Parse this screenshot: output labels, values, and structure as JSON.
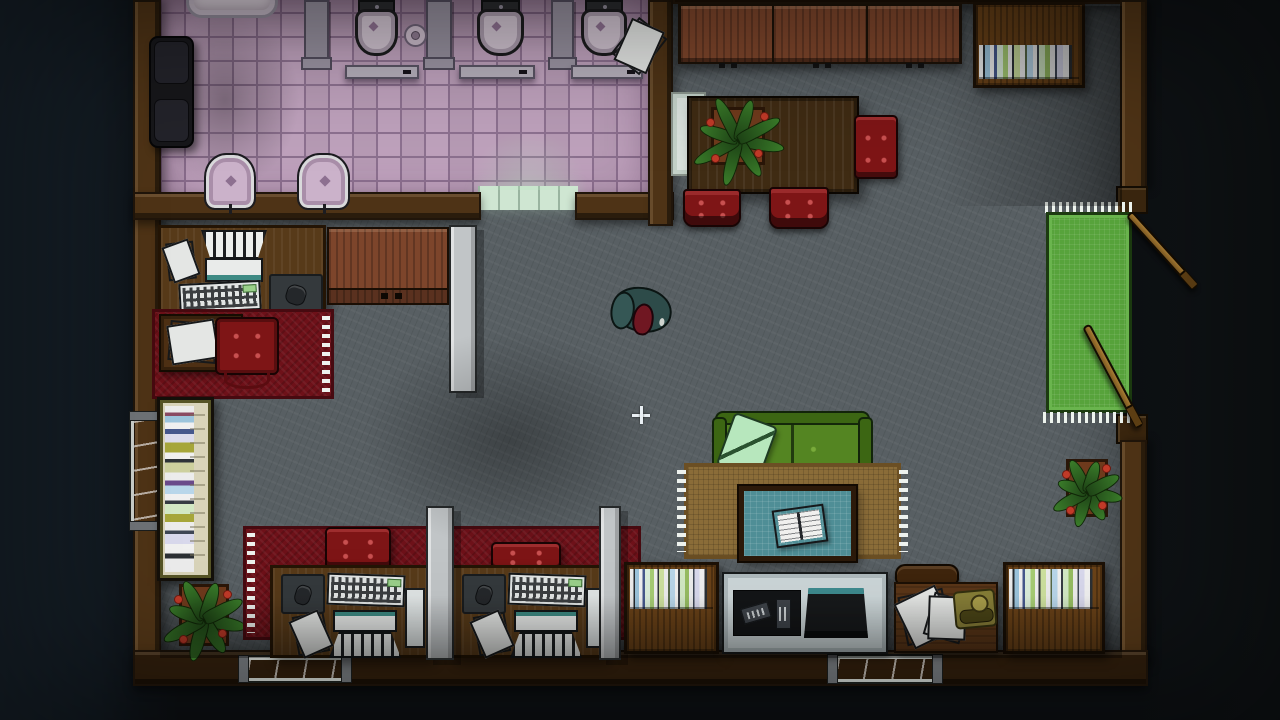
{
  "palette": {
    "floor": "#585f63",
    "tile": "#bfa2bd",
    "tile-grout": "#8d7190",
    "threshold": "#cfe6d2",
    "wall": "#4e3316",
    "wall-dark": "#20150a",
    "wood-panel": "#7d452b",
    "shelf-wood": "#6a4218",
    "table-wood": "#3f2b13",
    "desk-wood": "#573a19",
    "red-furn": "#7e1516",
    "red-rug": "#6e1119",
    "sofa": "#548522",
    "sofa-frame": "#3c6613",
    "pillow": "#b7e7bd",
    "rug-tan": "#8a6c38",
    "rug-tan-dark": "#6b4f24",
    "teal-table": "#4f8e96",
    "partition": "#c1c5c7",
    "window": "#74d6e4",
    "window-hi": "#b2eef6",
    "mat": "#57a33b",
    "flower": "#c03a28",
    "paper": "#eceeec",
    "phone": "#867d37",
    "tvstand": "#ccd6d8",
    "jacket": "#2d4b49",
    "head": "#701722",
    "crosshair": "#e9eff3"
  },
  "scene": {
    "width": 1280,
    "height": 720,
    "entities": [
      {
        "name": "main-floor",
        "type": "floor-main",
        "x": 160,
        "y": 4,
        "w": 962,
        "h": 656
      },
      {
        "name": "bathroom-floor",
        "type": "floor-bath",
        "x": 160,
        "y": 0,
        "w": 490,
        "h": 206
      },
      {
        "name": "bathroom-corner-shade",
        "type": "shade-d",
        "x": 150,
        "y": 10,
        "w": 150,
        "h": 180
      },
      {
        "name": "bathroom-door-threshold",
        "type": "threshold",
        "x": 478,
        "y": 186,
        "w": 100,
        "h": 24
      },
      {
        "name": "bathroom-door-glow",
        "type": "glow-door",
        "x": 468,
        "y": 130,
        "w": 120,
        "h": 60
      },
      {
        "name": "wall-left",
        "type": "wall",
        "variant": "v",
        "x": 133,
        "y": 0,
        "w": 28,
        "h": 670
      },
      {
        "name": "wall-bathroom-south-left",
        "type": "wall",
        "variant": "h",
        "x": 133,
        "y": 192,
        "w": 348,
        "h": 28
      },
      {
        "name": "wall-bathroom-south-right",
        "type": "wall",
        "variant": "h",
        "x": 575,
        "y": 192,
        "w": 99,
        "h": 28
      },
      {
        "name": "wall-bathroom-east",
        "type": "wall",
        "variant": "v",
        "x": 648,
        "y": 0,
        "w": 25,
        "h": 226
      },
      {
        "name": "wall-top-right",
        "type": "wall",
        "variant": "h dark",
        "x": 673,
        "y": -8,
        "w": 450,
        "h": 12
      },
      {
        "name": "wall-right-upper",
        "type": "wall",
        "variant": "v",
        "x": 1120,
        "y": 0,
        "w": 27,
        "h": 190
      },
      {
        "name": "door-jamb-upper",
        "type": "jamb",
        "x": 1116,
        "y": 186,
        "w": 32,
        "h": 28
      },
      {
        "name": "door-jamb-lower",
        "type": "jamb",
        "x": 1116,
        "y": 414,
        "w": 32,
        "h": 30
      },
      {
        "name": "wall-right-lower",
        "type": "wall",
        "variant": "v",
        "x": 1120,
        "y": 440,
        "w": 27,
        "h": 228
      },
      {
        "name": "wall-bottom",
        "type": "wall",
        "variant": "h dark",
        "x": 133,
        "y": 650,
        "w": 1015,
        "h": 36
      },
      {
        "name": "window-bottom-left",
        "type": "window",
        "x": 246,
        "y": 657,
        "w": 98,
        "h": 24
      },
      {
        "name": "window-bottom-right",
        "type": "window",
        "x": 835,
        "y": 656,
        "w": 100,
        "h": 26
      },
      {
        "name": "window-left-wall",
        "type": "window",
        "variant": "vert",
        "x": 131,
        "y": 418,
        "w": 29,
        "h": 106
      },
      {
        "name": "bathtub",
        "type": "bathtub",
        "x": 186,
        "y": -14,
        "w": 92,
        "h": 32
      },
      {
        "name": "black-armchair",
        "type": "armchair",
        "x": 149,
        "y": 36,
        "w": 45,
        "h": 112
      },
      {
        "name": "stall-divider-1",
        "type": "stall",
        "x": 304,
        "y": 0,
        "w": 25,
        "h": 64
      },
      {
        "name": "stall-divider-2",
        "type": "stall",
        "x": 426,
        "y": 0,
        "w": 26,
        "h": 64
      },
      {
        "name": "stall-divider-3",
        "type": "stall",
        "x": 551,
        "y": 0,
        "w": 23,
        "h": 64
      },
      {
        "name": "stall-door-1",
        "type": "stalldoor",
        "x": 345,
        "y": 65,
        "w": 74,
        "h": 14
      },
      {
        "name": "stall-door-2",
        "type": "stalldoor",
        "x": 459,
        "y": 65,
        "w": 76,
        "h": 14
      },
      {
        "name": "stall-door-3",
        "type": "stalldoor",
        "x": 571,
        "y": 65,
        "w": 72,
        "h": 14
      },
      {
        "name": "toilet-1",
        "type": "toilet",
        "x": 355,
        "y": 0,
        "w": 43,
        "h": 56
      },
      {
        "name": "toilet-2",
        "type": "toilet",
        "x": 477,
        "y": 0,
        "w": 47,
        "h": 56
      },
      {
        "name": "toilet-3",
        "type": "toilet",
        "x": 581,
        "y": 0,
        "w": 46,
        "h": 56
      },
      {
        "name": "toilet-paper-roll",
        "type": "roll",
        "x": 404,
        "y": 24,
        "w": 23,
        "h": 23
      },
      {
        "name": "scattered-papers-bathroom",
        "type": "papers",
        "x": 625,
        "y": 12,
        "w": 36,
        "h": 46,
        "rot": 38
      },
      {
        "name": "bidet-1",
        "type": "bidet",
        "x": 206,
        "y": 155,
        "w": 48,
        "h": 53
      },
      {
        "name": "bidet-2",
        "type": "bidet",
        "x": 299,
        "y": 155,
        "w": 49,
        "h": 53
      },
      {
        "name": "wall-cabinets",
        "type": "cabinets",
        "x": 678,
        "y": 4,
        "w": 284,
        "h": 60
      },
      {
        "name": "bookshelf-top-right",
        "type": "bookshelf",
        "variant": "books-mid",
        "x": 973,
        "y": 2,
        "w": 112,
        "h": 86
      },
      {
        "name": "glass-serving-tray",
        "type": "glass",
        "x": 671,
        "y": 92,
        "w": 35,
        "h": 84
      },
      {
        "name": "dining-table",
        "type": "table-wood",
        "x": 687,
        "y": 96,
        "w": 172,
        "h": 98
      },
      {
        "name": "dining-table-plant",
        "type": "plant",
        "x": 693,
        "y": 94,
        "w": 90,
        "h": 84
      },
      {
        "name": "dining-chair-east",
        "type": "redchair",
        "x": 854,
        "y": 115,
        "w": 44,
        "h": 64
      },
      {
        "name": "dining-chair-south-1",
        "type": "redchair",
        "variant": "pedestal",
        "x": 683,
        "y": 189,
        "w": 58,
        "h": 38
      },
      {
        "name": "dining-chair-south-2",
        "type": "redchair",
        "variant": "pedestal",
        "x": 769,
        "y": 187,
        "w": 60,
        "h": 42
      },
      {
        "name": "putting-mat-fringe-top",
        "type": "fringe",
        "x": 1045,
        "y": 202,
        "w": 88,
        "h": 11
      },
      {
        "name": "putting-mat",
        "type": "mat",
        "x": 1046,
        "y": 212,
        "w": 86,
        "h": 201
      },
      {
        "name": "putting-mat-fringe-bottom",
        "type": "fringe",
        "x": 1043,
        "y": 412,
        "w": 92,
        "h": 11
      },
      {
        "name": "golf-club-1",
        "type": "club",
        "x": 1129,
        "y": 209,
        "w": 100,
        "h": 9,
        "rot": 48
      },
      {
        "name": "golf-club-2",
        "type": "club",
        "x": 1086,
        "y": 321,
        "w": 115,
        "h": 9,
        "rot": 62
      },
      {
        "name": "potted-plant-right",
        "type": "plant",
        "x": 1052,
        "y": 446,
        "w": 70,
        "h": 84
      },
      {
        "name": "bookshelf-bottom-right",
        "type": "bookshelf",
        "variant": "books-top",
        "x": 1003,
        "y": 562,
        "w": 102,
        "h": 92
      },
      {
        "name": "office-desk-left",
        "type": "desk",
        "variant": "tpl-desk-left",
        "x": 158,
        "y": 225,
        "w": 168,
        "h": 92
      },
      {
        "name": "dresser",
        "type": "dresser",
        "x": 327,
        "y": 227,
        "w": 122,
        "h": 78
      },
      {
        "name": "partition-left-office",
        "type": "partition",
        "x": 449,
        "y": 225,
        "w": 28,
        "h": 168
      },
      {
        "name": "rug-red-left-office",
        "type": "rug-red",
        "variant": "fr",
        "x": 152,
        "y": 309,
        "w": 182,
        "h": 90
      },
      {
        "name": "side-table-papers",
        "type": "sidetable",
        "variant": "tpl-sidetable",
        "x": 159,
        "y": 314,
        "w": 84,
        "h": 58
      },
      {
        "name": "office-chair-red",
        "type": "officechair",
        "x": 215,
        "y": 317,
        "w": 64,
        "h": 58
      },
      {
        "name": "bookshelf-left-vertical",
        "type": "bookshelf-v",
        "x": 157,
        "y": 397,
        "w": 57,
        "h": 184
      },
      {
        "name": "potted-plant-bottom-left",
        "type": "plant",
        "x": 163,
        "y": 570,
        "w": 82,
        "h": 90
      },
      {
        "name": "rug-red-bottom-office",
        "type": "rug-red",
        "variant": "fl",
        "x": 243,
        "y": 526,
        "w": 398,
        "h": 114
      },
      {
        "name": "bottom-office-chair-1",
        "type": "redchair",
        "x": 325,
        "y": 527,
        "w": 66,
        "h": 42
      },
      {
        "name": "bottom-office-chair-2",
        "type": "redchair",
        "x": 491,
        "y": 542,
        "w": 70,
        "h": 30
      },
      {
        "name": "office-desk-bottom-1",
        "type": "desk",
        "variant": "tpl-desk-bottom",
        "x": 270,
        "y": 565,
        "w": 160,
        "h": 93
      },
      {
        "name": "office-desk-bottom-2",
        "type": "desk",
        "variant": "tpl-desk-bottom",
        "x": 451,
        "y": 565,
        "w": 154,
        "h": 93
      },
      {
        "name": "partition-bottom-1",
        "type": "partition",
        "x": 426,
        "y": 506,
        "w": 28,
        "h": 154
      },
      {
        "name": "partition-bottom-2",
        "type": "partition",
        "x": 599,
        "y": 506,
        "w": 22,
        "h": 154
      },
      {
        "name": "green-sofa",
        "type": "sofa",
        "variant": "tpl-sofa",
        "x": 712,
        "y": 411,
        "w": 161,
        "h": 74
      },
      {
        "name": "rug-tan-living",
        "type": "rug-tan",
        "x": 684,
        "y": 463,
        "w": 217,
        "h": 96
      },
      {
        "name": "coffee-table",
        "type": "coffee-table",
        "variant": "tpl-coffee",
        "x": 739,
        "y": 486,
        "w": 117,
        "h": 75
      },
      {
        "name": "bookshelf-bottom-middle",
        "type": "bookshelf",
        "variant": "books-top",
        "x": 624,
        "y": 562,
        "w": 95,
        "h": 92
      },
      {
        "name": "tv-stand",
        "type": "tvstand",
        "variant": "tpl-tvstand",
        "x": 722,
        "y": 572,
        "w": 166,
        "h": 82
      },
      {
        "name": "chair-back-brown",
        "type": "chairback",
        "x": 895,
        "y": 564,
        "w": 64,
        "h": 27
      },
      {
        "name": "phone-desk",
        "type": "phonedesk",
        "variant": "tpl-phonedesk",
        "x": 894,
        "y": 582,
        "w": 104,
        "h": 71
      },
      {
        "name": "player-character",
        "type": "character",
        "variant": "tpl-character",
        "x": 612,
        "y": 281,
        "w": 60,
        "h": 52,
        "rot": 8,
        "interactable": "true"
      },
      {
        "name": "dining-shade-right",
        "type": "shade-right",
        "x": 940,
        "y": 6,
        "w": 182,
        "h": 200
      },
      {
        "name": "floor-shade-bottom",
        "type": "shade-down",
        "x": 160,
        "y": 596,
        "w": 962,
        "h": 62
      },
      {
        "name": "floor-shade-center",
        "type": "shade-d",
        "x": 360,
        "y": 330,
        "w": 300,
        "h": 220
      },
      {
        "name": "vignette",
        "type": "vignette",
        "x": 0,
        "y": 0,
        "w": 1280,
        "h": 720
      },
      {
        "name": "crosshair-cursor",
        "type": "crosshair",
        "x": 632,
        "y": 406,
        "w": 18,
        "h": 18,
        "interactable": "true"
      }
    ]
  }
}
